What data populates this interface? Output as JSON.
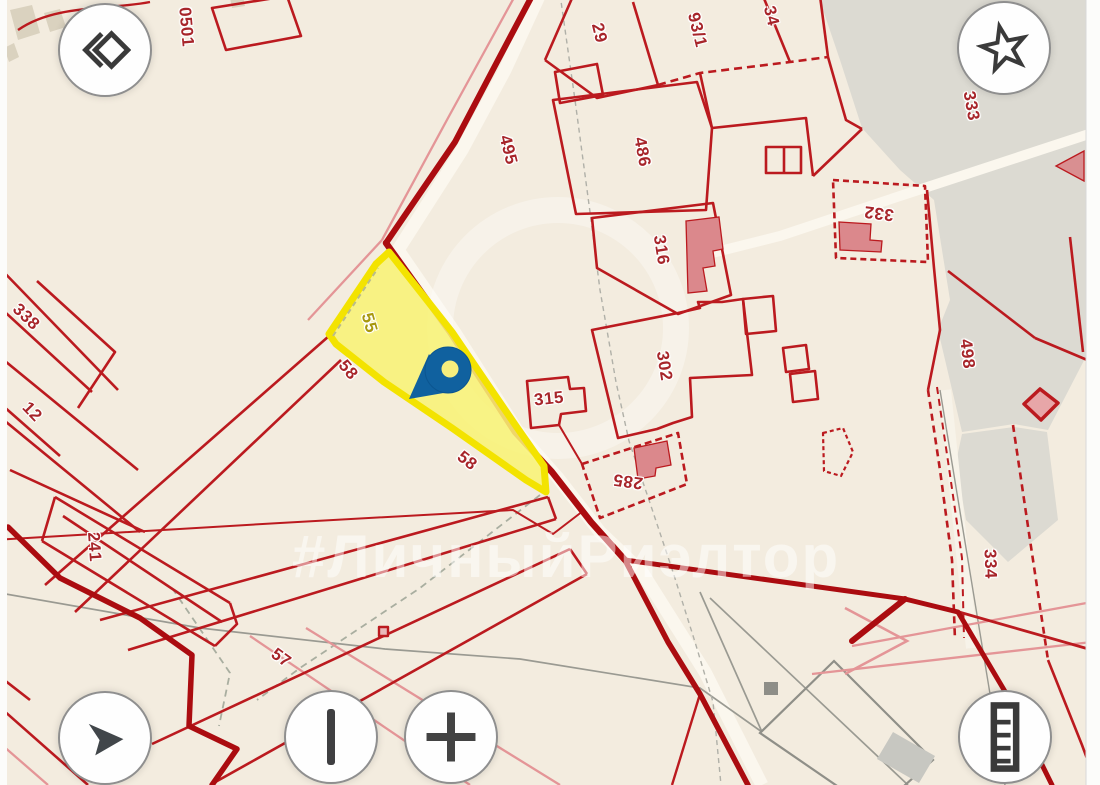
{
  "map": {
    "watermark": "#ЛичныйРиэлтор",
    "zone_label": "0501",
    "highlight": {
      "fill": "#f8f276",
      "border": "#f3e300",
      "parcel_label": "55"
    },
    "colors": {
      "background": "#f3ecdf",
      "boundary_red": "#bb1a1f",
      "road_dark_red": "#ab0c10",
      "gray_zone": "#dcdad2",
      "pin_blue": "#10619f",
      "label_red": "#a7252a",
      "label_yellow": "#a8980e"
    },
    "labels": [
      {
        "text": "0501",
        "x": 186,
        "y": 27,
        "rot": 85
      },
      {
        "text": "29",
        "x": 599,
        "y": 33,
        "rot": 76
      },
      {
        "text": "93/1",
        "x": 697,
        "y": 30,
        "rot": 76
      },
      {
        "text": "34",
        "x": 771,
        "y": 16,
        "rot": 76
      },
      {
        "text": "333",
        "x": 971,
        "y": 106,
        "rot": 80
      },
      {
        "text": "332",
        "x": 879,
        "y": 213,
        "rot": 187
      },
      {
        "text": "495",
        "x": 508,
        "y": 150,
        "rot": 76
      },
      {
        "text": "486",
        "x": 642,
        "y": 152,
        "rot": 79
      },
      {
        "text": "316",
        "x": 661,
        "y": 250,
        "rot": 81
      },
      {
        "text": "302",
        "x": 664,
        "y": 366,
        "rot": 81
      },
      {
        "text": "315",
        "x": 549,
        "y": 399,
        "rot": -6
      },
      {
        "text": "285",
        "x": 628,
        "y": 481,
        "rot": 188
      },
      {
        "text": "498",
        "x": 967,
        "y": 354,
        "rot": 83
      },
      {
        "text": "334",
        "x": 990,
        "y": 564,
        "rot": 88
      },
      {
        "text": "338",
        "x": 26,
        "y": 317,
        "rot": 44
      },
      {
        "text": "12",
        "x": 32,
        "y": 412,
        "rot": 46
      },
      {
        "text": "241",
        "x": 94,
        "y": 547,
        "rot": 86
      },
      {
        "text": "57",
        "x": 281,
        "y": 658,
        "rot": 36
      },
      {
        "text": "58",
        "x": 348,
        "y": 370,
        "rot": 50
      },
      {
        "text": "58",
        "x": 467,
        "y": 461,
        "rot": 38
      },
      {
        "text": "55",
        "x": 369,
        "y": 323,
        "rot": 74,
        "color": "#a8980e"
      }
    ]
  },
  "controls": {
    "top_left_button": {
      "icon": "layers-diamond-icon"
    },
    "favorites_button": {
      "icon": "star-icon"
    },
    "location_button": {
      "icon": "navigation-arrow-icon"
    },
    "zoom_out_button": {
      "icon": "vertical-bar-icon"
    },
    "zoom_in_button": {
      "icon": "plus-icon"
    },
    "measure_button": {
      "icon": "ruler-icon"
    }
  }
}
